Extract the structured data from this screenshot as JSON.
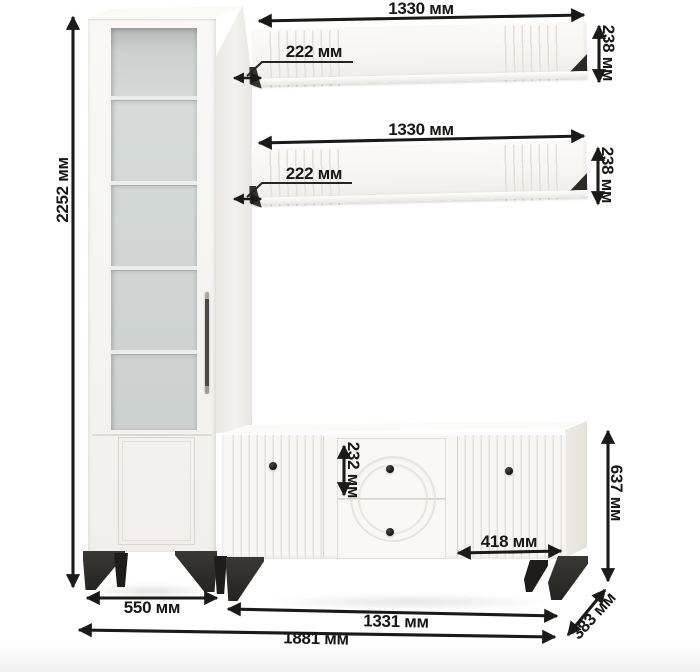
{
  "colors": {
    "background": "#ffffff",
    "furniture_white": "#f7f6f3",
    "glass": "#cfd4d2",
    "leg_black": "#2d2b28",
    "dimension_ink": "#1a1a19"
  },
  "dimensions": {
    "cabinet_height": "2252 мм",
    "shelf_top": {
      "width": "1330 мм",
      "height": "238 мм",
      "depth": "222 мм"
    },
    "shelf_bottom": {
      "width": "1330 мм",
      "height": "238 мм",
      "depth": "222 мм"
    },
    "drawer_height": "232 мм",
    "right_door_width": "418 мм",
    "sideboard_height": "637 мм",
    "cabinet_width": "550 мм",
    "sideboard_width": "1331 мм",
    "total_width": "1881 мм",
    "unit_depth": "383 мм"
  }
}
